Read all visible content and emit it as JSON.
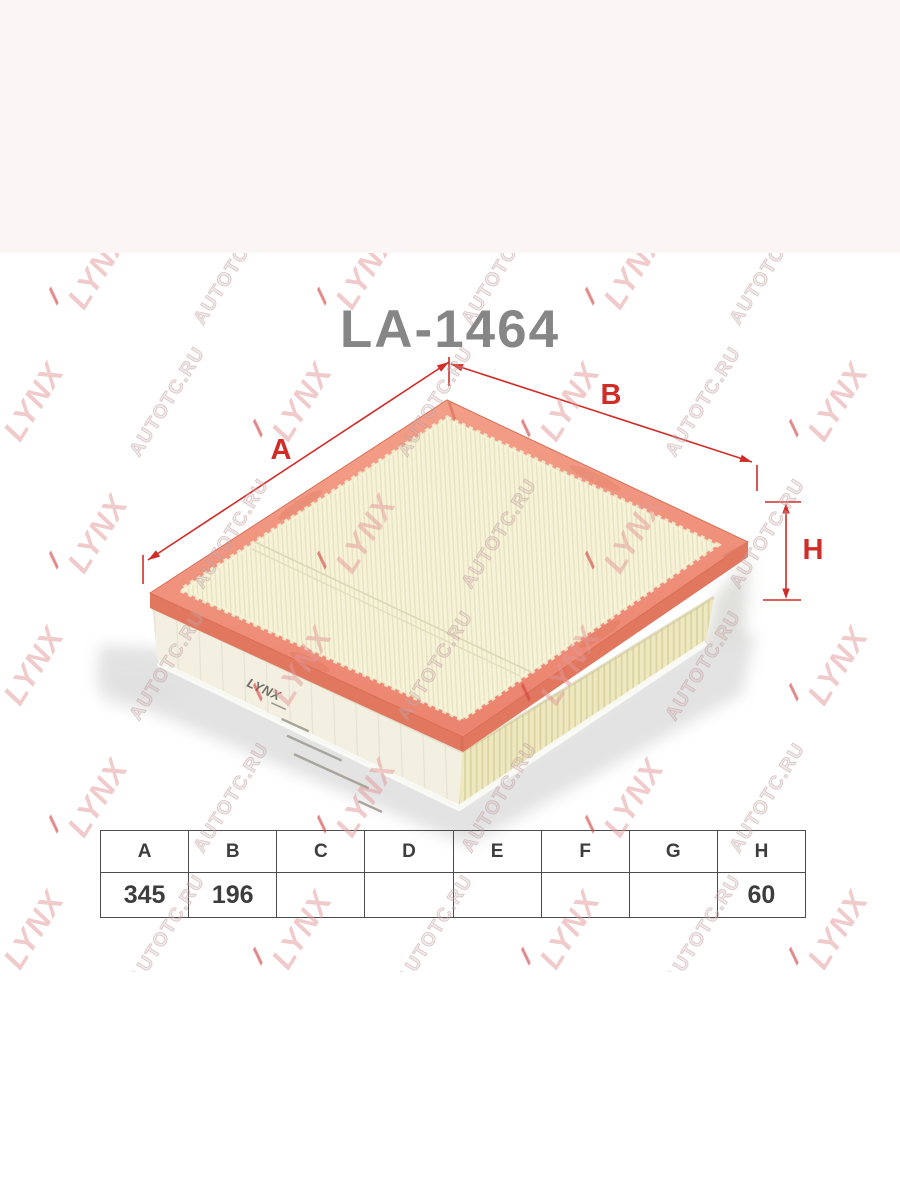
{
  "window": {
    "width": 900,
    "height": 1200
  },
  "product": {
    "title": "LA-1464",
    "side_print": "LYNX",
    "dimension_labels": {
      "a": "A",
      "b": "B",
      "h": "H"
    }
  },
  "watermark": {
    "brand": "LYNX",
    "site": "AUTOTC.RU",
    "accent": "∕∕"
  },
  "table": {
    "headers": [
      "A",
      "B",
      "C",
      "D",
      "E",
      "F",
      "G",
      "H"
    ],
    "values": [
      "345",
      "196",
      "",
      "",
      "",
      "",
      "",
      "60"
    ]
  },
  "colors": {
    "top_band": "#fbf5f6",
    "title_gray": "#868686",
    "dimension_red": "#d02c28",
    "frame_salmon": "#f0937f",
    "frame_lip": "#e0775e",
    "paper_cream": "#f7f3d8",
    "side_right_cream": "#eee8c0",
    "side_left_white": "#f3f0e2",
    "table_border": "#4c4c4c"
  }
}
